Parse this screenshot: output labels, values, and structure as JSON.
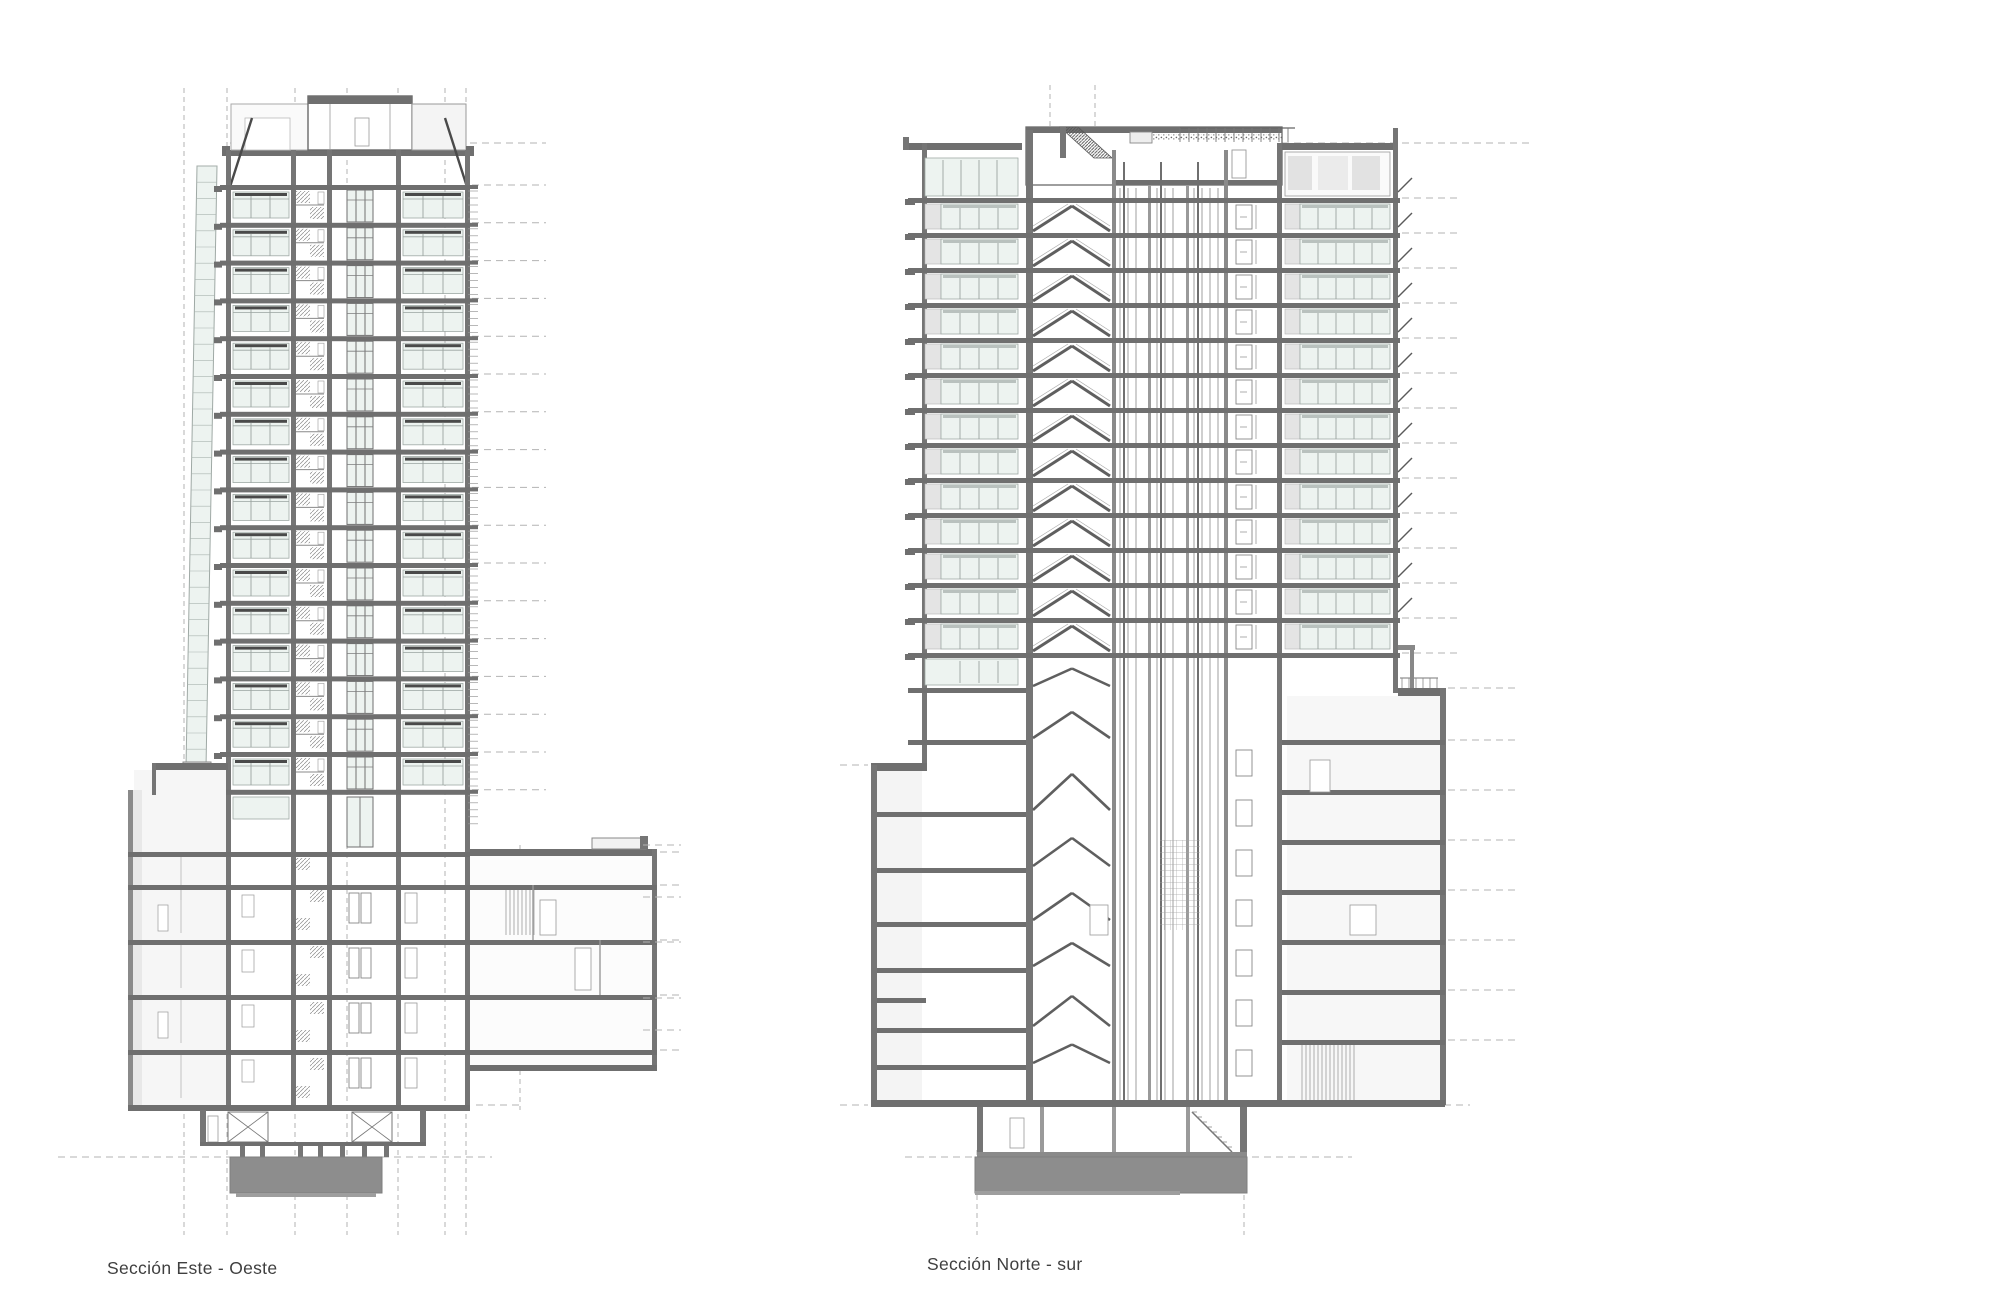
{
  "page": {
    "background": "#ffffff",
    "type": "architectural-section-drawing"
  },
  "sections": [
    {
      "id": "este-oeste",
      "label": "Sección Este - Oeste",
      "tower_typical_floors": 16,
      "podium_levels": 5,
      "basement_levels": 2,
      "core": "central stair + elevator core"
    },
    {
      "id": "norte-sur",
      "label": "Sección Norte - sur",
      "tower_typical_floors": 13,
      "podium_levels": 7,
      "basement_levels": 1,
      "core": "stair, triple elevator shafts, lobby"
    }
  ],
  "palette": {
    "line": "#4f4f4f",
    "slab": "#6f6f6f",
    "wall": "#757575",
    "wall_dark": "#5f5f5f",
    "foundation": "#8d8d8d",
    "glass": "#edf3f0",
    "glass_border": "#9fa9a5",
    "panel": "#e4e6e4",
    "interior": "#f4f4f3",
    "grid": "#b3b3b3",
    "shadow": "#b9c1be",
    "text": "#3f3f3f"
  }
}
